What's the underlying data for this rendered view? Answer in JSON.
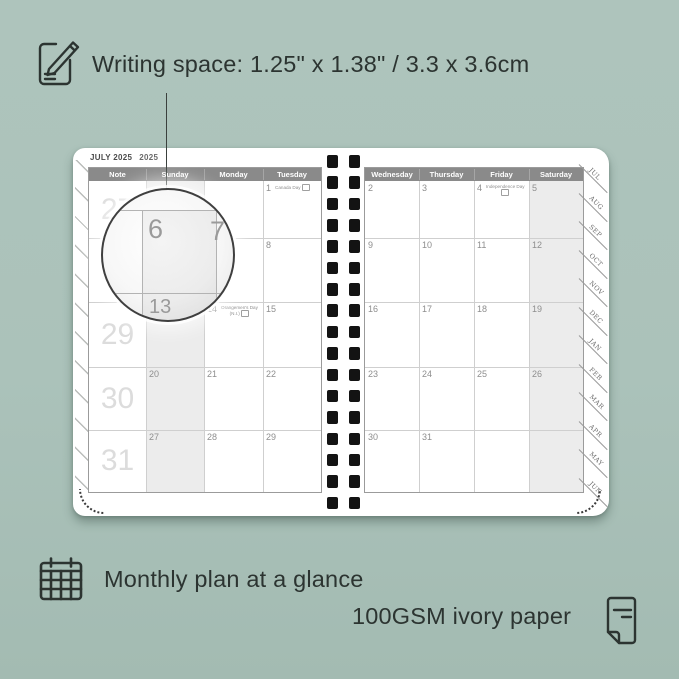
{
  "colors": {
    "background": "#abc2ba",
    "ink": "#2c3431",
    "header_bg": "#8a8a8a",
    "weekend_shade": "#ececec",
    "page_white": "#ffffff",
    "spiral_hole": "#131313"
  },
  "annotations": {
    "writing_space": "Writing space: 1.25\" x 1.38\" / 3.3 x 3.6cm",
    "monthly_plan": "Monthly plan at a glance",
    "paper": "100GSM ivory paper"
  },
  "icons": {
    "top_left": "pencil-note-icon",
    "bottom_left": "calendar-grid-icon",
    "bottom_right": "paper-sheet-icon"
  },
  "planner": {
    "month_title": "JULY 2025",
    "year_label": "2025",
    "left_page": {
      "headers": [
        "Note",
        "Sunday",
        "Monday",
        "Tuesday"
      ],
      "week_numbers": [
        "27",
        "28",
        "29",
        "30",
        "31"
      ],
      "shaded_column": 1,
      "rows": [
        [
          {
            "d": ""
          },
          {
            "d": ""
          },
          {
            "d": "1",
            "holiday": {
              "name": "Canada Day",
              "inline": true
            }
          }
        ],
        [
          {
            "d": "6"
          },
          {
            "d": "7"
          },
          {
            "d": "8"
          }
        ],
        [
          {
            "d": "13"
          },
          {
            "d": "14",
            "holiday": {
              "name": "Orangemen's Day",
              "line2": "(N.I.)"
            }
          },
          {
            "d": "15"
          }
        ],
        [
          {
            "d": "20"
          },
          {
            "d": "21"
          },
          {
            "d": "22"
          }
        ],
        [
          {
            "d": "27"
          },
          {
            "d": "28"
          },
          {
            "d": "29"
          }
        ]
      ]
    },
    "right_page": {
      "headers": [
        "Wednesday",
        "Thursday",
        "Friday",
        "Saturday"
      ],
      "shaded_column": 3,
      "rows": [
        [
          {
            "d": "2"
          },
          {
            "d": "3"
          },
          {
            "d": "4",
            "holiday": {
              "name": "Independence Day",
              "line2": ""
            }
          },
          {
            "d": "5"
          }
        ],
        [
          {
            "d": "9"
          },
          {
            "d": "10"
          },
          {
            "d": "11"
          },
          {
            "d": "12"
          }
        ],
        [
          {
            "d": "16"
          },
          {
            "d": "17"
          },
          {
            "d": "18"
          },
          {
            "d": "19"
          }
        ],
        [
          {
            "d": "23"
          },
          {
            "d": "24"
          },
          {
            "d": "25"
          },
          {
            "d": "26"
          }
        ],
        [
          {
            "d": "30"
          },
          {
            "d": "31"
          },
          {
            "d": ""
          },
          {
            "d": ""
          }
        ]
      ]
    },
    "tabs": [
      "JUL",
      "AUG",
      "SEP",
      "OCT",
      "NOV",
      "DEC",
      "JAN",
      "FEB",
      "MAR",
      "APR",
      "MAY",
      "JUN"
    ],
    "spiral": {
      "holes_per_column": 17
    },
    "magnifier": {
      "day_large": "6",
      "day_right": "7",
      "day_below": "13"
    }
  }
}
